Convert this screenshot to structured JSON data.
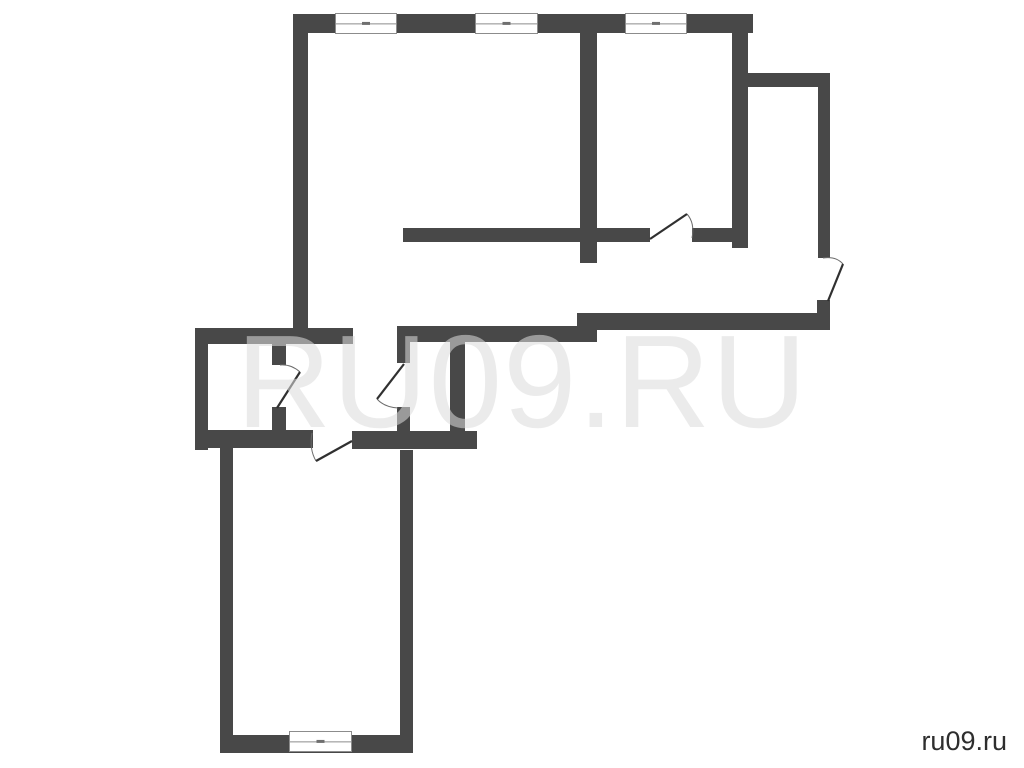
{
  "watermark": {
    "text": "RU09.RU"
  },
  "credit": {
    "text": "ru09.ru"
  },
  "floor_plan": {
    "background": "#ffffff",
    "wall_color": "#484848",
    "window_stroke": "#8c8c8c",
    "window_fill": "#ffffff",
    "window_tick_color": "#6f6f6f",
    "door_leaf_color": "#303030",
    "door_arc_color": "#6b6b6b",
    "walls": [
      {
        "name": "top-exterior-wall",
        "x": 293,
        "y": 14,
        "w": 460,
        "h": 19
      },
      {
        "name": "left-exterior-wall",
        "x": 293,
        "y": 33,
        "w": 15,
        "h": 297
      },
      {
        "name": "room-divider-left",
        "x": 580,
        "y": 33,
        "w": 17,
        "h": 230
      },
      {
        "name": "room-divider-right",
        "x": 732,
        "y": 14,
        "w": 16,
        "h": 234
      },
      {
        "name": "entry-nook-top-wall",
        "x": 745,
        "y": 73,
        "w": 85,
        "h": 14
      },
      {
        "name": "right-exterior-wall",
        "x": 818,
        "y": 87,
        "w": 12,
        "h": 171
      },
      {
        "name": "right-exterior-wall-stub",
        "x": 817,
        "y": 300,
        "w": 13,
        "h": 15
      },
      {
        "name": "hall-partition-left",
        "x": 403,
        "y": 228,
        "w": 247,
        "h": 14
      },
      {
        "name": "hall-partition-right",
        "x": 692,
        "y": 228,
        "w": 45,
        "h": 14
      },
      {
        "name": "hall-bottom-wall-right",
        "x": 577,
        "y": 313,
        "w": 253,
        "h": 17
      },
      {
        "name": "hall-bottom-wall-left",
        "x": 397,
        "y": 326,
        "w": 200,
        "h": 16
      },
      {
        "name": "wet-block-top-wall",
        "x": 195,
        "y": 328,
        "w": 158,
        "h": 16
      },
      {
        "name": "wet-block-left-wall",
        "x": 195,
        "y": 328,
        "w": 13,
        "h": 122
      },
      {
        "name": "wet-block-bottom-wall",
        "x": 195,
        "y": 430,
        "w": 118,
        "h": 18
      },
      {
        "name": "bottom-room-top-wall",
        "x": 352,
        "y": 431,
        "w": 125,
        "h": 18
      },
      {
        "name": "wet-divider-upper",
        "x": 272,
        "y": 344,
        "w": 14,
        "h": 21
      },
      {
        "name": "wet-divider-lower",
        "x": 272,
        "y": 407,
        "w": 14,
        "h": 24
      },
      {
        "name": "corridor-divider-upper",
        "x": 397,
        "y": 342,
        "w": 13,
        "h": 21
      },
      {
        "name": "corridor-divider-lower",
        "x": 397,
        "y": 407,
        "w": 13,
        "h": 26
      },
      {
        "name": "closet-right-wall",
        "x": 450,
        "y": 342,
        "w": 15,
        "h": 90
      },
      {
        "name": "bottom-room-left-wall",
        "x": 220,
        "y": 448,
        "w": 13,
        "h": 305
      },
      {
        "name": "bottom-room-right-wall",
        "x": 400,
        "y": 450,
        "w": 13,
        "h": 303
      },
      {
        "name": "bottom-room-bottom-wall",
        "x": 220,
        "y": 735,
        "w": 193,
        "h": 18
      }
    ],
    "windows": [
      {
        "name": "window-top-1",
        "x": 335,
        "y": 13,
        "w": 62,
        "h": 21
      },
      {
        "name": "window-top-2",
        "x": 475,
        "y": 13,
        "w": 63,
        "h": 21
      },
      {
        "name": "window-top-3",
        "x": 625,
        "y": 13,
        "w": 62,
        "h": 21
      },
      {
        "name": "window-bottom",
        "x": 289,
        "y": 731,
        "w": 63,
        "h": 21
      }
    ],
    "doors": [
      {
        "name": "door-room-right",
        "leaf": [
          650,
          239,
          687,
          214
        ],
        "arc": "M687,214 Q695,223 692,238"
      },
      {
        "name": "door-entrance",
        "leaf": [
          828,
          301,
          843,
          264
        ],
        "arc": "M843,264 Q836,256 823,258"
      },
      {
        "name": "door-wet-divider",
        "leaf": [
          277,
          408,
          300,
          372
        ],
        "arc": "M300,372 Q291,364 280,365"
      },
      {
        "name": "door-corridor",
        "leaf": [
          404,
          364,
          377,
          399
        ],
        "arc": "M377,399 Q384,407 398,408"
      },
      {
        "name": "door-bottom-room",
        "leaf": [
          352,
          441,
          316,
          461
        ],
        "arc": "M316,461 Q309,449 312,433"
      }
    ]
  }
}
